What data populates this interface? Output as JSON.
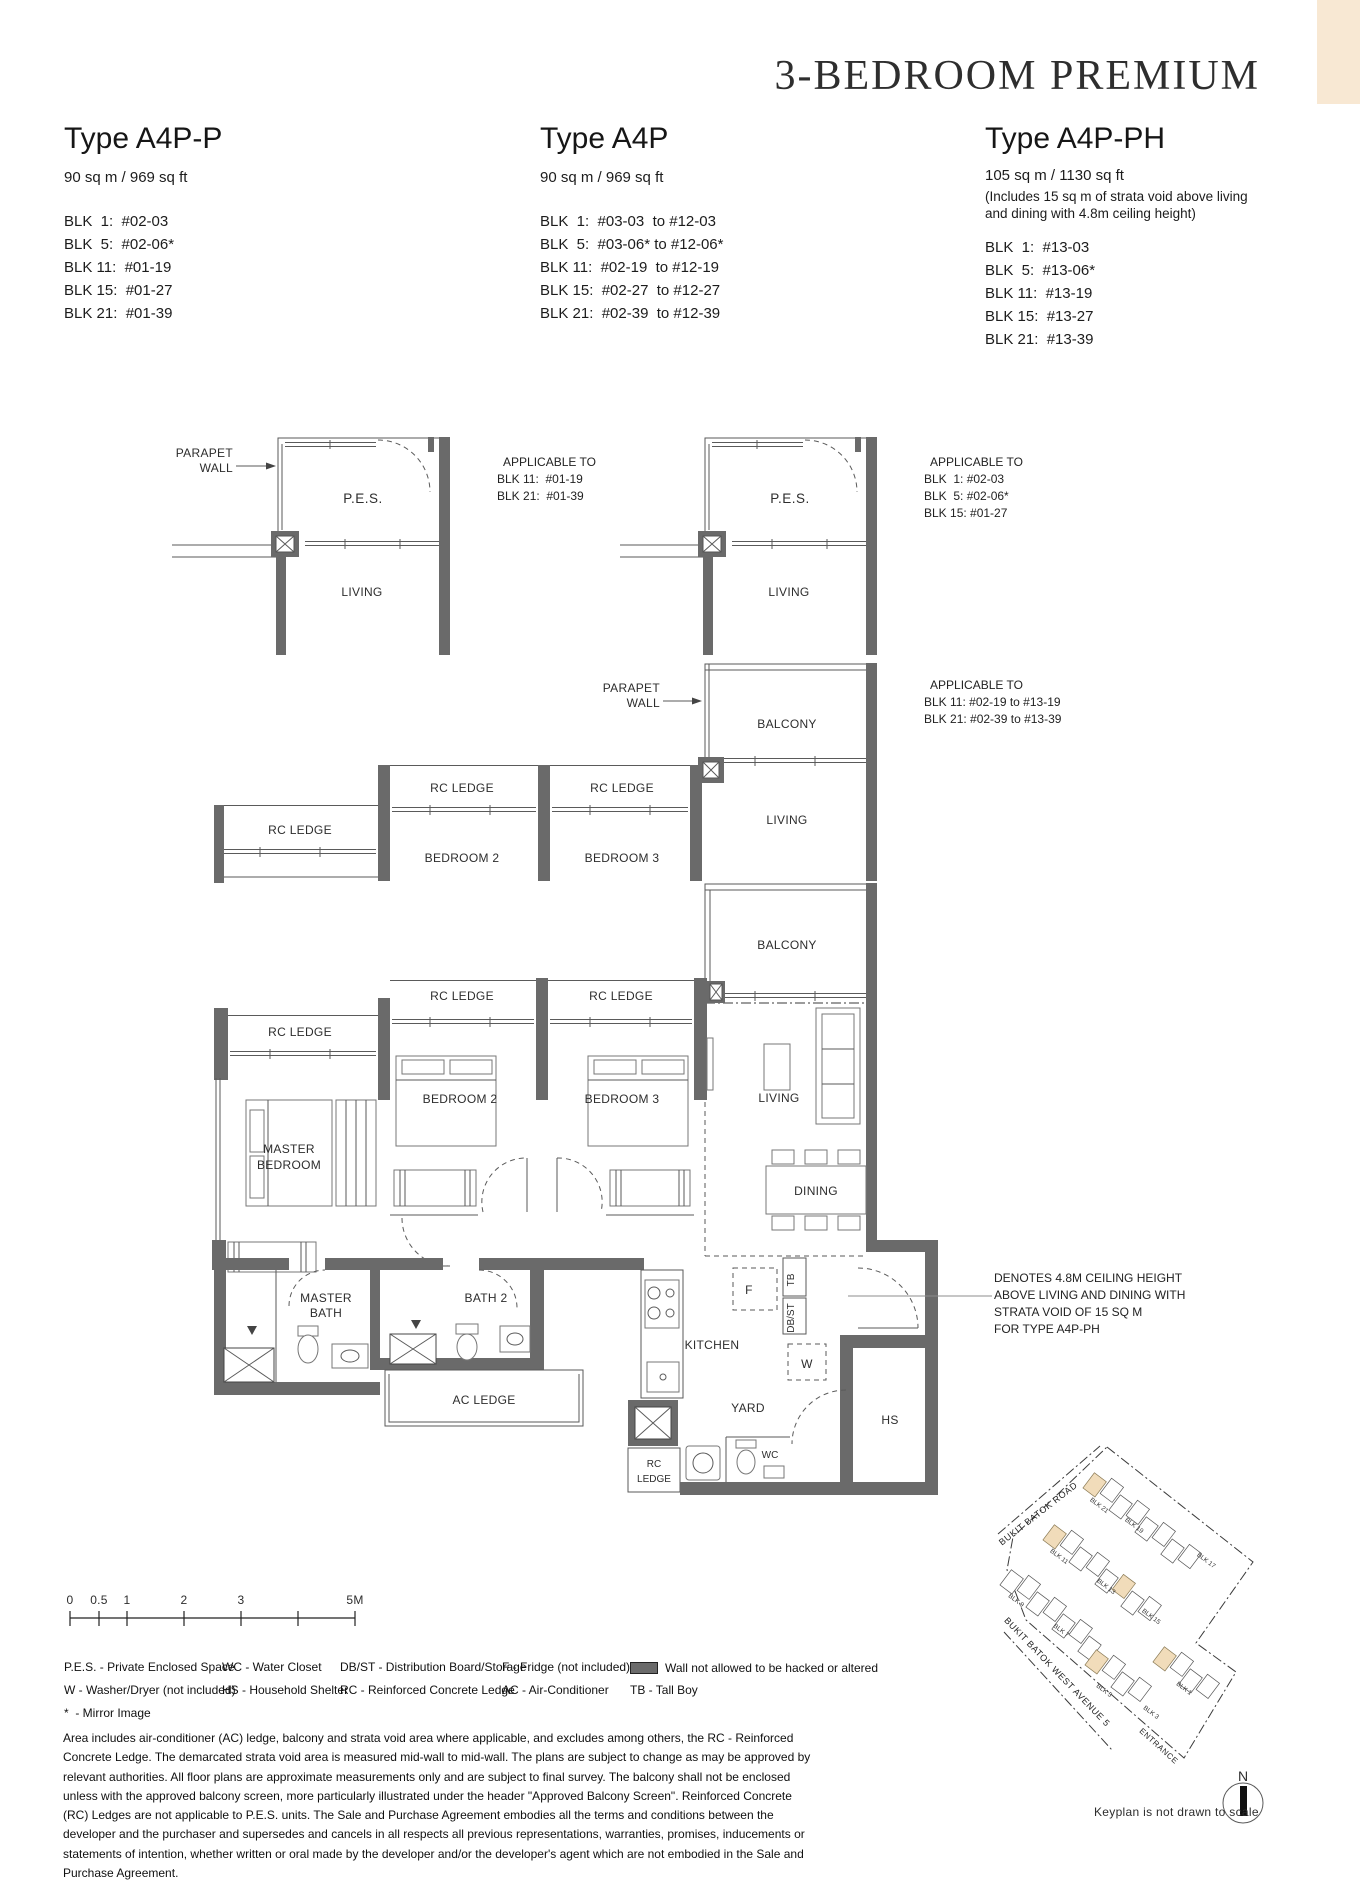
{
  "page": {
    "title": "3-BEDROOM PREMIUM"
  },
  "types": [
    {
      "name": "Type A4P-P",
      "area": "90 sq m / 969 sq ft",
      "extra": "",
      "blocks": [
        "BLK  1:  #02-03",
        "BLK  5:  #02-06*",
        "BLK 11:  #01-19",
        "BLK 15:  #01-27",
        "BLK 21:  #01-39"
      ]
    },
    {
      "name": "Type A4P",
      "area": "90 sq m / 969 sq ft",
      "extra": "",
      "blocks": [
        "BLK  1:  #03-03  to #12-03",
        "BLK  5:  #03-06* to #12-06*",
        "BLK 11:  #02-19  to #12-19",
        "BLK 15:  #02-27  to #12-27",
        "BLK 21:  #02-39  to #12-39"
      ]
    },
    {
      "name": "Type A4P-PH",
      "area": "105 sq m / 1130 sq ft",
      "extra": "(Includes 15 sq m of strata void above living and dining with 4.8m ceiling height)",
      "blocks": [
        "BLK  1:  #13-03",
        "BLK  5:  #13-06*",
        "BLK 11:  #13-19",
        "BLK 15:  #13-27",
        "BLK 21:  #13-39"
      ]
    }
  ],
  "applicable": [
    {
      "title": "APPLICABLE TO",
      "lines": [
        "BLK 11:  #01-19",
        "BLK 21:  #01-39"
      ]
    },
    {
      "title": "APPLICABLE TO",
      "lines": [
        "BLK  1: #02-03",
        "BLK  5: #02-06*",
        "BLK 15: #01-27"
      ]
    },
    {
      "title": "APPLICABLE TO",
      "lines": [
        "BLK 11: #02-19 to #13-19",
        "BLK 21: #02-39 to #13-39"
      ]
    }
  ],
  "plan": {
    "labels": {
      "pes": "P.E.S.",
      "living": "LIVING",
      "balcony": "BALCONY",
      "rc_ledge": "RC LEDGE",
      "rc": "RC",
      "ledge": "LEDGE",
      "bedroom2": "BEDROOM 2",
      "bedroom3": "BEDROOM 3",
      "master1": "MASTER",
      "master2": "BEDROOM",
      "dining": "DINING",
      "mbath1": "MASTER",
      "mbath2": "BATH",
      "bath2": "BATH 2",
      "kitchen": "KITCHEN",
      "yard": "YARD",
      "ac_ledge": "AC LEDGE",
      "wc": "WC",
      "hs": "HS",
      "f": "F",
      "w": "W",
      "tb": "TB",
      "dbst": "DB/ST",
      "parapet1": "PARAPET",
      "parapet2": "WALL"
    }
  },
  "note": {
    "lines": [
      "DENOTES 4.8M CEILING HEIGHT",
      "ABOVE LIVING AND DINING WITH",
      "STRATA VOID OF 15 SQ M",
      "FOR TYPE A4P-PH"
    ]
  },
  "scalebar": {
    "ticks": [
      "0",
      "0.5",
      "1",
      "2",
      "3",
      "5M"
    ]
  },
  "legend": {
    "col1": [
      "P.E.S. - Private Enclosed Space",
      "W - Washer/Dryer (not included)",
      "*  - Mirror Image"
    ],
    "col2": [
      "WC - Water Closet",
      "HS - Household Shelter"
    ],
    "col3": [
      "DB/ST - Distribution Board/Storage",
      "RC - Reinforced Concrete Ledge"
    ],
    "col4": [
      "F - Fridge (not included)",
      "AC - Air-Conditioner"
    ],
    "wall_note": "Wall not allowed to be hacked or altered",
    "tb_note": "TB - Tall Boy"
  },
  "disclaimer": "Area includes air-conditioner (AC) ledge, balcony and strata void area where applicable, and excludes among others, the RC - Reinforced Concrete Ledge. The demarcated strata void area is measured mid-wall to mid-wall. The plans are subject to change as may be approved by relevant authorities. All floor plans are approximate measurements only and are subject to final survey. The balcony shall not be enclosed unless with the approved balcony screen, more particularly illustrated under the header \"Approved Balcony Screen\". Reinforced Concrete (RC) Ledges are not applicable to P.E.S. units. The Sale and Purchase Agreement embodies all the terms and conditions between the developer and the purchaser and supersedes and cancels in all respects all previous representations, warranties, promises, inducements or statements of intention, whether written or oral made by the developer and/or the developer's agent which are not embodied in the Sale and Purchase Agreement.",
  "keyplan": {
    "road1": "BUKIT BATOK ROAD",
    "road2": "BUKIT BATOK WEST AVENUE 5",
    "entrance": "ENTRANCE",
    "note": "Keyplan is not drawn to scale",
    "north": "N",
    "blocks": [
      "BLK 21",
      "BLK 19",
      "BLK 17",
      "BLK 11",
      "BLK 13",
      "BLK 15",
      "BLK 9",
      "BLK 7",
      "BLK 5",
      "BLK 3",
      "BLK 1"
    ]
  }
}
